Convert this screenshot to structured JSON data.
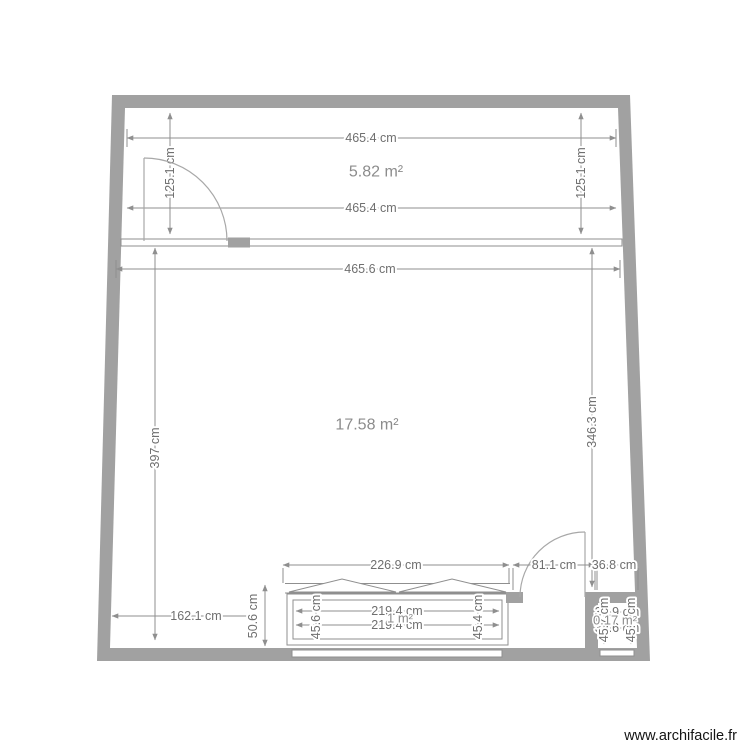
{
  "watermark": {
    "label": "www.archifacile.fr"
  },
  "colors": {
    "wall": "#a1a1a1",
    "dim_line": "#8f8f8f",
    "dim_text": "#6f6f6f",
    "area_text": "#8c8c8c",
    "door": "#a8a8a8",
    "watermark_text": "#141414"
  },
  "top_room": {
    "area": "5.82 m²",
    "dim_top": "465.4 cm",
    "dim_bottom": "465.4 cm",
    "dim_left": "125.1 cm",
    "dim_right": "125.1 cm"
  },
  "main_room": {
    "area": "17.58 m²",
    "dim_top": "465.6 cm",
    "dim_left": "397 cm",
    "dim_right": "346.3 cm",
    "dim_bottom_left": "162.1 cm"
  },
  "closet": {
    "area": "1 m²",
    "dim_outer_top": "226.9 cm",
    "dim_inner_top": "219.4 cm",
    "dim_inner_bottom": "219.4 cm",
    "dim_left": "45.6 cm",
    "dim_right": "45.4 cm",
    "dim_depth": "50.6 cm"
  },
  "entry": {
    "dim_door": "81.1 cm"
  },
  "small_room": {
    "area": "0.17 m²",
    "dim_width": "36.8 cm",
    "dim_top": "35.9 cm",
    "dim_bottom": "34.6 cm",
    "dim_left": "45.7 cm",
    "dim_right": "45.4 cm"
  }
}
